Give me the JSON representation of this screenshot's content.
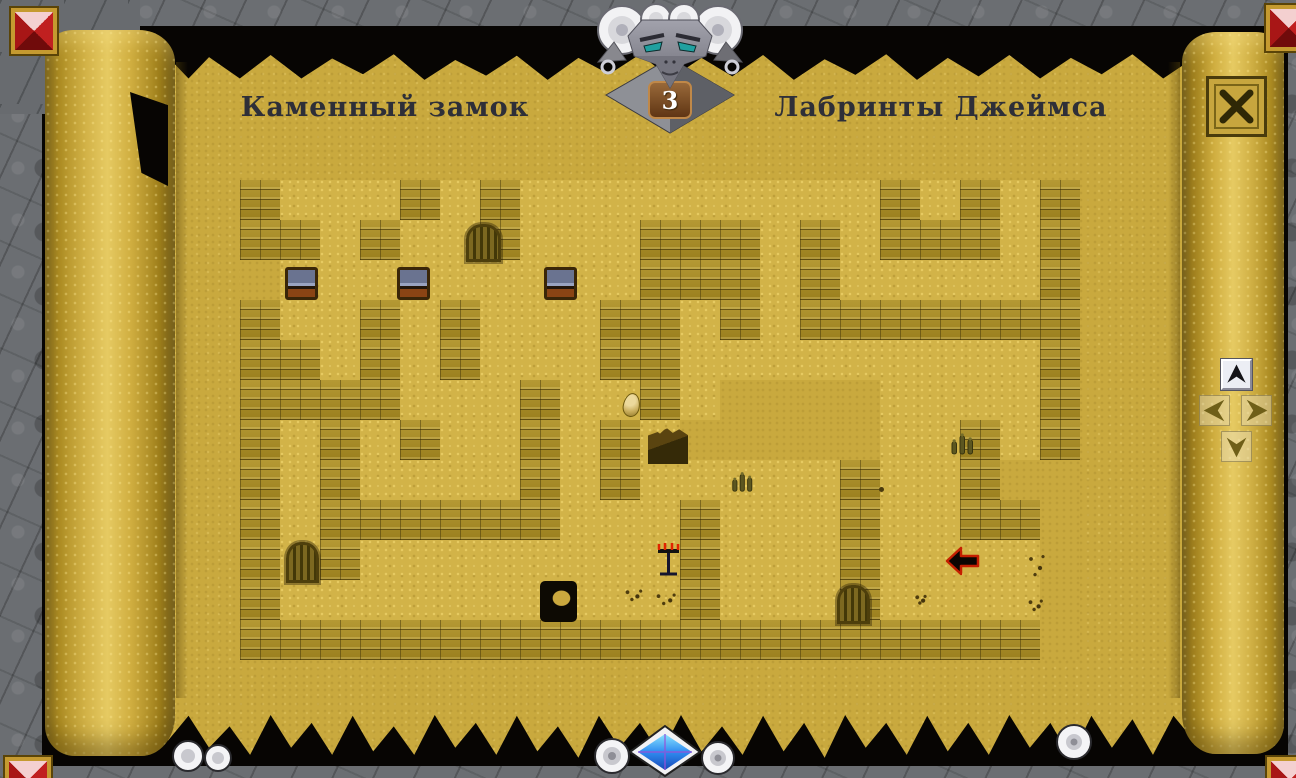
{
  "titles": {
    "left": "Каменный замок",
    "right": "Лабринты Джеймса"
  },
  "level_badge": {
    "value": "3"
  },
  "icons": {
    "header": "horned-demon-head",
    "close": "x-cross",
    "nav_up": "arrow-up",
    "nav_left": "arrow-left",
    "nav_right": "arrow-right",
    "nav_down": "arrow-down",
    "corners": "red-pyramid-gem",
    "bottom_center": "scroll-curls-with-blue-gem"
  },
  "nav_state": {
    "up_enabled": true,
    "left_enabled": false,
    "right_enabled": false,
    "down_enabled": false
  },
  "colors": {
    "parchment": "#c9a93e",
    "sand": "#d2b348",
    "wall": "#a98d26",
    "stone": "#6b6e72",
    "torn_black": "#070503",
    "title_text": "#2e2f38",
    "badge_plate": "#7a4a22",
    "badge_text": "#ffffff",
    "gem_red": "#c02020",
    "gem_blue": "#2f8cf0",
    "eye_teal": "#20a0a0",
    "marker_red": "#c41e00"
  },
  "maze": {
    "origin_x": 240,
    "origin_y": 180,
    "tile_size": 40,
    "cols": 21,
    "rows_count": 12,
    "legend": {
      "#": "wall",
      ".": "sand",
      " ": "parchment-gap"
    },
    "rows": [
      "#...#.#.........#.#.#",
      "##.#..#...###.#.###.#",
      " .........###.#.....#",
      "#..#.#...##.#.#######",
      "##.#.#...##.........#",
      "####...#..#.    ....#",
      "#.#.#..#.#.     ..#.#",
      "#.#....#.#.....#..#  ",
      "#.######...#...#..## ",
      "#.#........#...#.... ",
      "#..........#...#.... ",
      "#################### "
    ]
  },
  "items": [
    {
      "type": "chest",
      "x": 285,
      "y": 267,
      "w": 33,
      "h": 33
    },
    {
      "type": "chest",
      "x": 397,
      "y": 267,
      "w": 33,
      "h": 33
    },
    {
      "type": "chest",
      "x": 544,
      "y": 267,
      "w": 33,
      "h": 33
    },
    {
      "type": "gate",
      "x": 466,
      "y": 224,
      "w": 35,
      "h": 38
    },
    {
      "type": "gate",
      "x": 286,
      "y": 542,
      "w": 33,
      "h": 41
    },
    {
      "type": "gate",
      "x": 837,
      "y": 585,
      "w": 33,
      "h": 39
    },
    {
      "type": "pit",
      "x": 540,
      "y": 581,
      "w": 37,
      "h": 41
    },
    {
      "type": "rubble",
      "x": 648,
      "y": 427,
      "w": 40,
      "h": 37
    },
    {
      "type": "egg",
      "x": 623,
      "y": 393,
      "w": 17,
      "h": 24
    },
    {
      "type": "candelabra",
      "x": 655,
      "y": 541,
      "w": 27,
      "h": 38
    },
    {
      "type": "player-arrow",
      "x": 945,
      "y": 546,
      "w": 35,
      "h": 30
    },
    {
      "type": "cactus",
      "x": 949,
      "y": 429,
      "w": 27,
      "h": 28
    },
    {
      "type": "cactus",
      "x": 729,
      "y": 468,
      "w": 27,
      "h": 26
    },
    {
      "type": "bones",
      "x": 622,
      "y": 588,
      "w": 22,
      "h": 14
    },
    {
      "type": "bones",
      "x": 652,
      "y": 592,
      "w": 26,
      "h": 14
    },
    {
      "type": "bones",
      "x": 1026,
      "y": 550,
      "w": 20,
      "h": 30
    },
    {
      "type": "bones",
      "x": 1026,
      "y": 598,
      "w": 18,
      "h": 14
    },
    {
      "type": "bones",
      "x": 914,
      "y": 594,
      "w": 13,
      "h": 11
    },
    {
      "type": "dot",
      "x": 879,
      "y": 487,
      "w": 5,
      "h": 5
    }
  ]
}
